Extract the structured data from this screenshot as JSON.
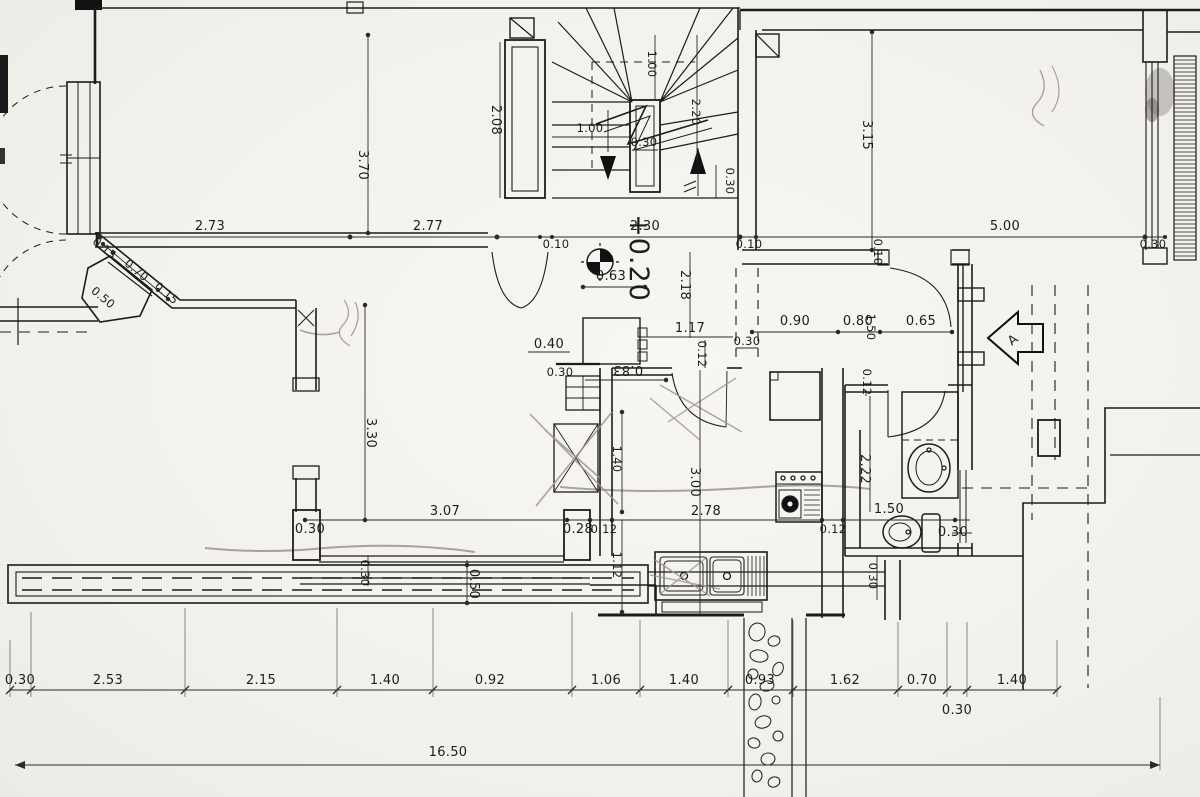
{
  "annotations": {
    "level_mark": "+0.20",
    "section_marker": "A"
  },
  "dims": {
    "top_left_room_width_a": "2.73",
    "top_left_room_width_b": "2.77",
    "wall_gap_left": "0.10",
    "stair_width": "2.30",
    "wall_gap_right": "0.10",
    "right_room_width": "5.00",
    "right_wall_thickness": "0.30",
    "right_wall_offset": "0.10",
    "top_left_room_depth": "3.70",
    "stair_closet_depth": "2.08",
    "right_room_depth": "3.15",
    "stair_flight_width": "1.00",
    "stair_run": "1.00",
    "stair_well": "0.30",
    "stair_length": "2.20",
    "stair_wall": "0.30",
    "hall_depth": "2.18",
    "hall_niche_width": "0.63",
    "hall_width": "1.17",
    "hall_chain_a": "0.90",
    "hall_chain_b": "0.80",
    "hall_passage_depth": "1.50",
    "hall_chain_c": "0.65",
    "hall_wall_left": "0.30",
    "hall_step": "0.40",
    "hall_jamb": "0.12",
    "kitchen_door_width": "0.83",
    "kitchen_wall": "0.30",
    "kitchen_depth_a": "1.40",
    "kitchen_depth_b": "3.00",
    "kitchen_width": "2.78",
    "kitchen_counter_depth": "1.12",
    "living_width": "3.07",
    "living_wall": "0.30",
    "living_jamb_a": "0.28",
    "living_jamb_b": "0.12",
    "kitchen_jamb_right": "0.12",
    "window_offset": "0.30",
    "planter_depth": "0.50",
    "living_room_depth": "3.30",
    "bath_depth": "2.22",
    "bath_width": "1.50",
    "bath_window": "0.30",
    "bath_wall_bottom": "0.30",
    "bath_jamb": "0.12",
    "chamfer_left": "0.15",
    "chamfer_width": "0.70",
    "chamfer_right": "0.15",
    "chamfer_depth": "0.50",
    "bottom_chain": [
      "0.30",
      "2.53",
      "2.15",
      "1.40",
      "0.92",
      "1.06",
      "1.40",
      "0.93",
      "1.62",
      "0.70",
      "0.30",
      "1.40"
    ],
    "overall_width": "16.50"
  }
}
